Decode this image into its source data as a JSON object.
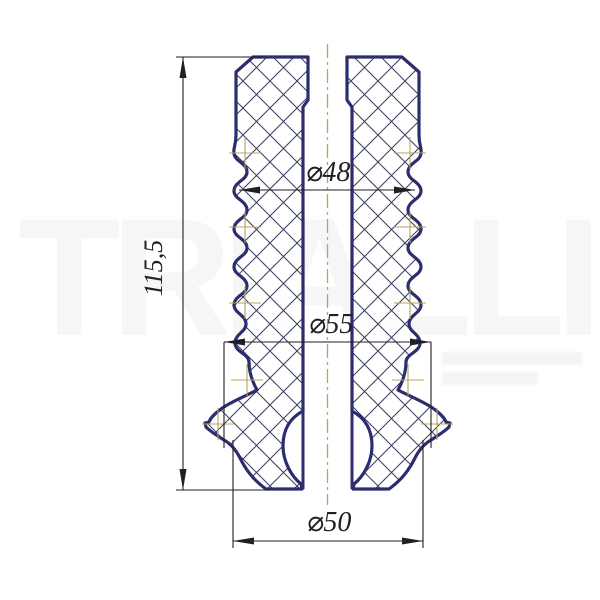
{
  "drawing": {
    "title": "bump-stop cross-section drawing",
    "dimensions": {
      "height": "115,5",
      "dia_top": "⌀48",
      "dia_mid": "⌀55",
      "dia_bottom": "⌀50"
    },
    "colors": {
      "outline": "#2b2d6e",
      "hatch": "#3a3a5e",
      "dimension": "#1f1f24",
      "centerline": "#b9a45e",
      "background": "#ffffff"
    }
  },
  "watermark": {
    "brand": "TRIALLI"
  }
}
